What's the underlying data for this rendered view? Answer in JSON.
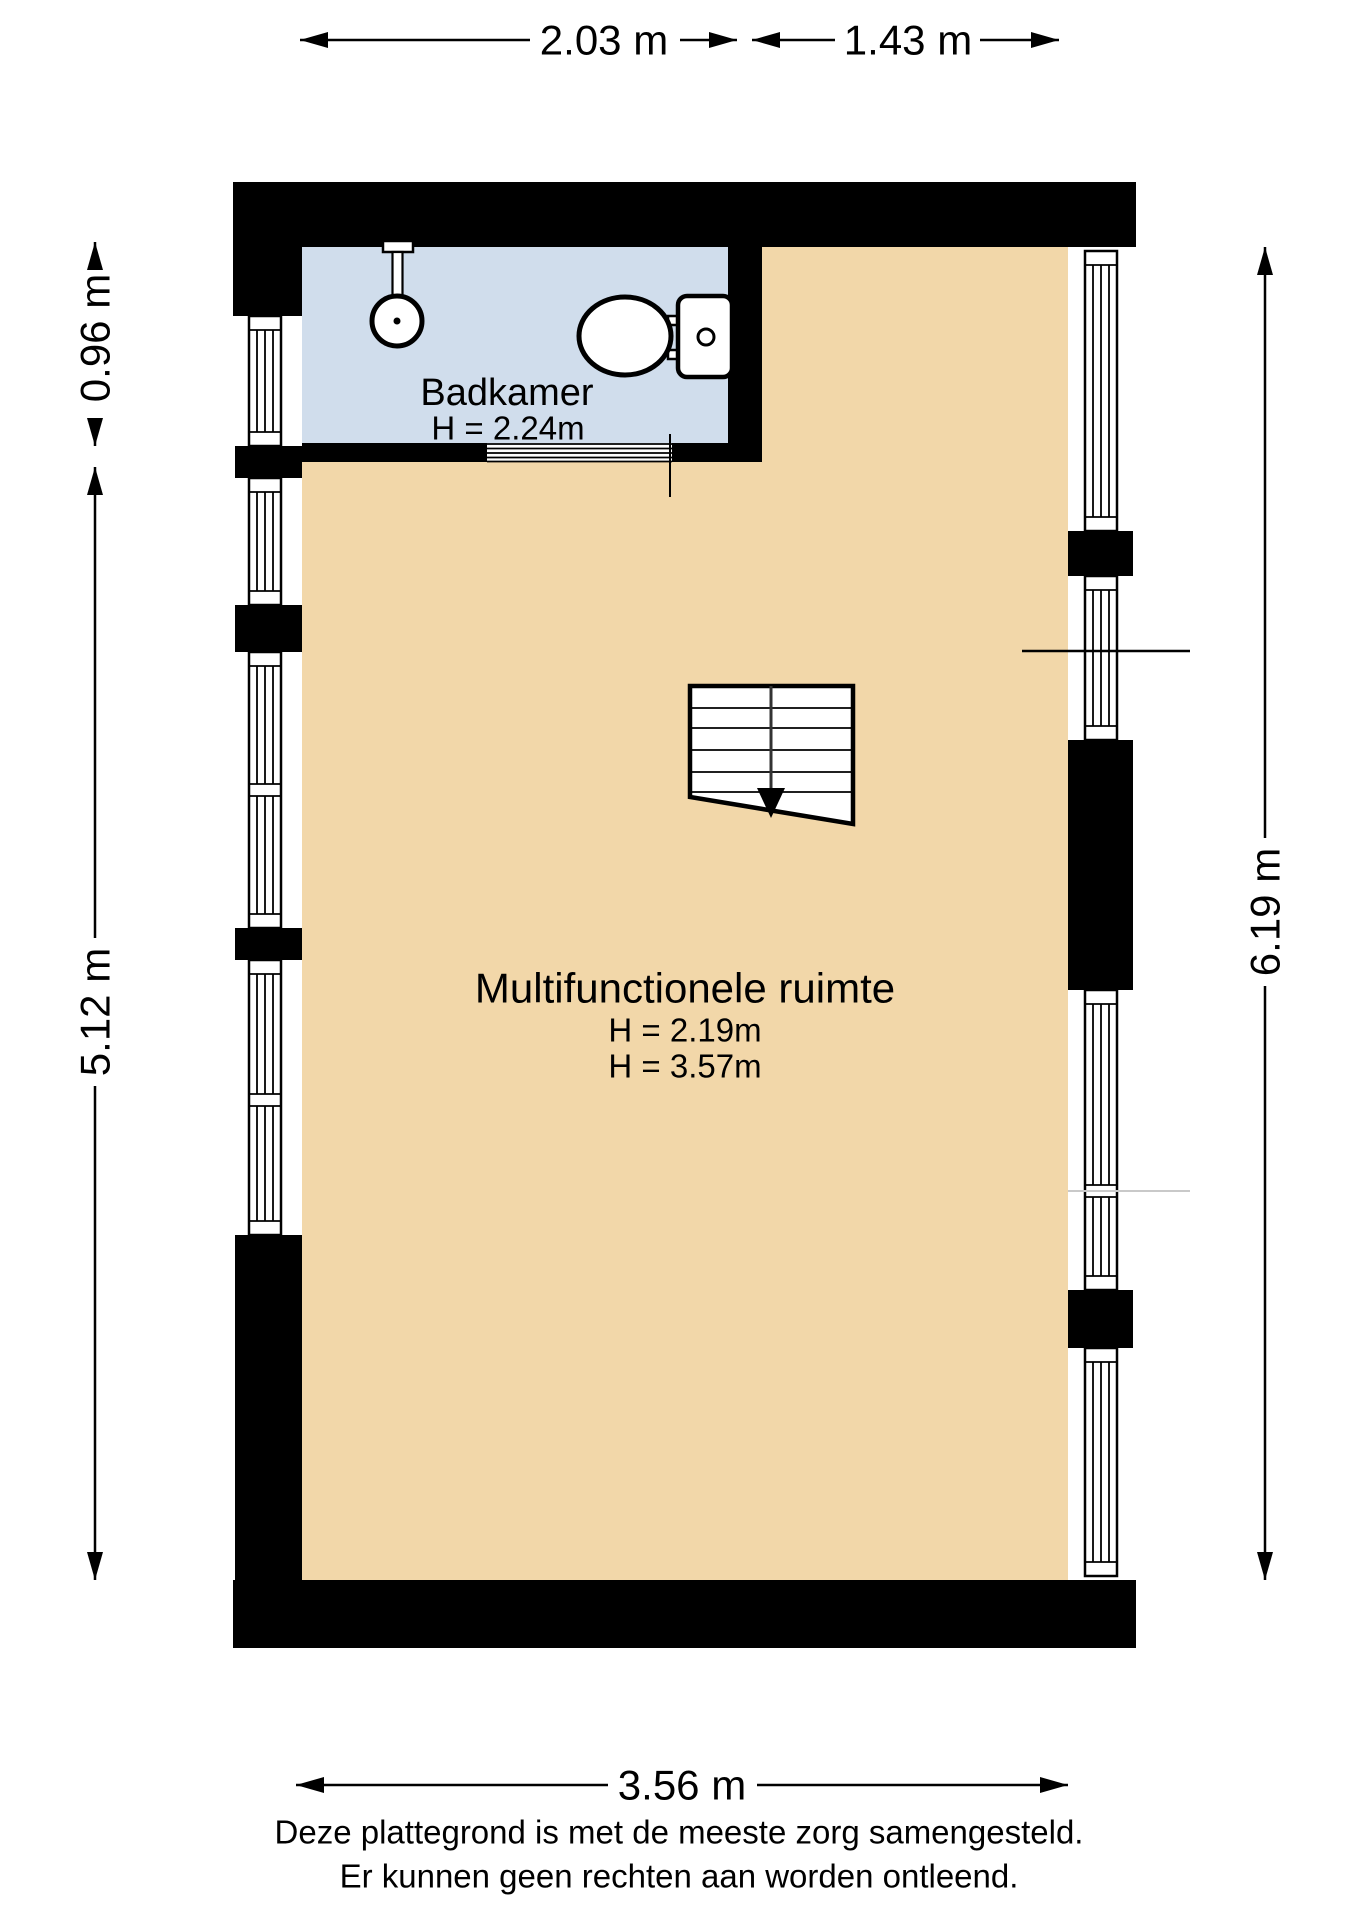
{
  "plan_labels": {
    "bathroom": {
      "name": "Badkamer",
      "height": "H = 2.24m"
    },
    "main_room": {
      "name": "Multifunctionele ruimte",
      "height_1": "H = 2.19m",
      "height_2": "H = 3.57m"
    }
  },
  "dimensions": {
    "top_bathroom_width": "2.03 m",
    "top_right_width": "1.43 m",
    "left_bathroom_height": "0.96 m",
    "left_room_height": "5.12 m",
    "right_total_height": "6.19 m",
    "bottom_total_width": "3.56 m"
  },
  "disclaimer": {
    "line_1": "Deze plattegrond is met de meeste zorg samengesteld.",
    "line_2": "Er kunnen geen rechten aan worden ontleend."
  },
  "fixtures": {
    "toilet": "toilet-top-view",
    "shower": "shower-head",
    "stairs": "stairs-with-down-arrow"
  },
  "colors": {
    "wall": "#000000",
    "floor_main": "#f2d7a9",
    "floor_bathroom": "#d0ddec",
    "divider_light": "#c9c9c9",
    "background": "#ffffff"
  }
}
